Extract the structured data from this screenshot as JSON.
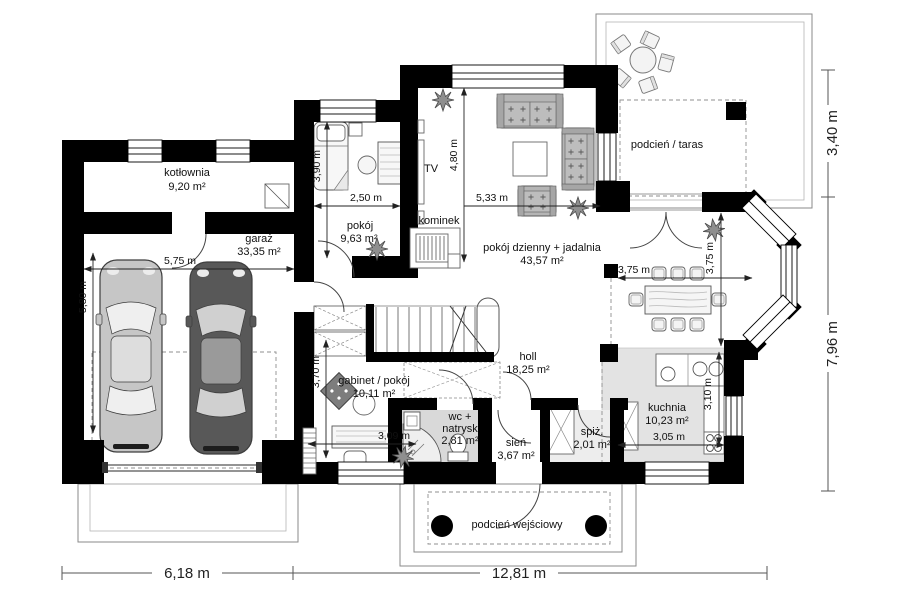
{
  "rooms": {
    "kotlownia": {
      "label": "kotłownia",
      "area": "9,20 m²"
    },
    "garaz": {
      "label": "garaż",
      "area": "33,35 m²"
    },
    "pokoj": {
      "label": "pokój",
      "area": "9,63 m²"
    },
    "pokoj_dzienny": {
      "label": "pokój dzienny + jadalnia",
      "area": "43,57 m²"
    },
    "holl": {
      "label": "holl",
      "area": "18,25 m²"
    },
    "gabinet": {
      "label": "gabinet / pokój",
      "area": "10,11 m²"
    },
    "wc": {
      "label_line1": "wc +",
      "label_line2": "natrysk",
      "area": "2,81 m²"
    },
    "sien": {
      "label": "sień",
      "area": "3,67 m²"
    },
    "spiz": {
      "label": "spiż.",
      "area": "2,01 m²"
    },
    "kuchnia": {
      "label": "kuchnia",
      "area": "10,23 m²"
    },
    "taras": {
      "label": "podcień / taras"
    },
    "wejscie": {
      "label": "podcień wejściowy"
    }
  },
  "annotations": {
    "tv": "TV",
    "kominek": "kominek"
  },
  "dims": {
    "garage_w": "5,75 m",
    "garage_h": "5,80 m",
    "pokoj_h": "3,90 m",
    "pokoj_w": "2,50 m",
    "living_h": "4,80 m",
    "living_w": "5,33 m",
    "dining_w": "3,75 m",
    "dining_h": "3,75 m",
    "gabinet_h": "3,70 m",
    "gabinet_w": "3,09 m",
    "kuchnia_h": "3,10 m",
    "kuchnia_w": "3,05 m"
  },
  "overall_dims": {
    "bottom_left": "6,18 m",
    "bottom_right": "12,81 m",
    "right_top": "3,40 m",
    "right_bottom": "7,96 m"
  },
  "colors": {
    "wall": "#000000",
    "wc_floor": "#d9d9d9",
    "kitchen_floor": "#e3e3e3",
    "car_light": "#c6c6c6",
    "car_dark": "#585858"
  }
}
